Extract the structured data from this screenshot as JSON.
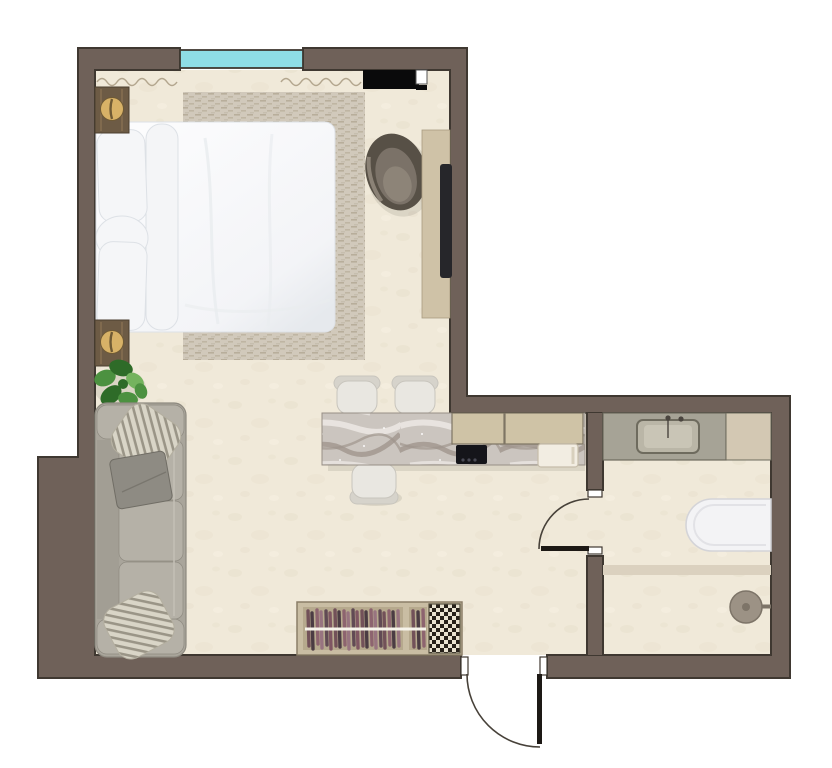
{
  "scene": {
    "aria_label": "Top-down 3D rendered floor plan of a studio apartment",
    "type": "floor-plan-rendering"
  },
  "inventory": {
    "rooms": [
      "bedroom-living-area",
      "kitchen",
      "entry-hall",
      "bathroom"
    ],
    "furniture": [
      "double-bed",
      "bed-pillows",
      "area-rug",
      "nightstand-top",
      "nightstand-bottom",
      "table-lamp",
      "monstera-plant",
      "sofa",
      "knit-pillow",
      "gray-throw",
      "armchair",
      "media-console",
      "tv",
      "wall-shelf",
      "kitchen-island",
      "bar-chair",
      "upper-cabinets",
      "wardrobe-rack",
      "houndstooth-mat"
    ],
    "fixtures": [
      "window",
      "curtain",
      "induction-cooktop",
      "kitchen-sink",
      "bathroom-vanity",
      "sink-basin",
      "faucet",
      "toilet",
      "shower-screen",
      "shower-drain",
      "interior-door",
      "entry-door"
    ],
    "window_count": 1,
    "door_count": 2,
    "bar_chair_count": 3,
    "sofa_seat_count": 3
  },
  "colors": {
    "exterior": "#ffffff",
    "wall": "#6f6159",
    "wall_line": "#3f3831",
    "floor": "#f0e9d9",
    "floor_speckle": "#dfd5bf",
    "window_glass": "#8edde6",
    "curtain": "#b3a68e",
    "rug": "#d1c9bb",
    "rug_dash": "#b2a893",
    "bedding": "#fbfbfd",
    "bedding_shade": "#dde1e6",
    "pillow": "#f5f6f8",
    "nightstand": "#6d5b45",
    "nightstand_streak": "#8b7355",
    "lamp": "#d8b267",
    "lamp_dark": "#6f5a35",
    "plant": "#4c9140",
    "plant_dark": "#2e6b28",
    "plant_light": "#74b35e",
    "sofa": "#a9a59b",
    "sofa_line": "#8e8a80",
    "sofa_cushion": "#b5b1a7",
    "knit": "#d9d5c7",
    "knit_stripe": "#8f8a7c",
    "throw": "#8e8b83",
    "throw_dark": "#706d65",
    "armchair_back": "#575046",
    "armchair_seat": "#7b7268",
    "armchair_light": "#988e82",
    "console": "#cfc2a7",
    "console_line": "#a89b80",
    "tv": "#26262a",
    "shelf": "#0a0a0b",
    "marble": "#cbc5bf",
    "marble_vein": "#a0968d",
    "marble_light": "#ebe7e3",
    "cabinet": "#cfc3a6",
    "cabinet_line": "#7e7565",
    "cooktop": "#15151a",
    "cooktop_knob": "#4a4a55",
    "sink": "#f2ede2",
    "sink_line": "#c6bdaa",
    "chair": "#e9e7e1",
    "chair_line": "#c8c5bd",
    "chair_back": "#d6d3cb",
    "vanity_top": "#a6a396",
    "vanity_line": "#6e6b5e",
    "basin": "#bab6a7",
    "basin_inner": "#c9c5b6",
    "faucet": "#4a453f",
    "bath_cabinet": "#d3c8b3",
    "toilet": "#f3f3f5",
    "toilet_line": "#d4d4d8",
    "shower_screen": "#dbd1bf",
    "shower_head": "#9c9285",
    "shower_head_dark": "#7d7468",
    "wardrobe_frame": "#c9bda3",
    "wardrobe_inner": "#b6a98d",
    "rail": "#f6f3ea",
    "mat": "#e9e2d0",
    "mat_check": "#262019",
    "door_leaf": "#1d1915",
    "door_arc": "#474139",
    "jamb": "#ffffff",
    "clothes1": "#6d4a55",
    "clothes2": "#43333d",
    "clothes3": "#8a5f6d",
    "clothes4": "#96707f",
    "clothes5": "#5a4350",
    "clothes6": "#7b505f"
  }
}
